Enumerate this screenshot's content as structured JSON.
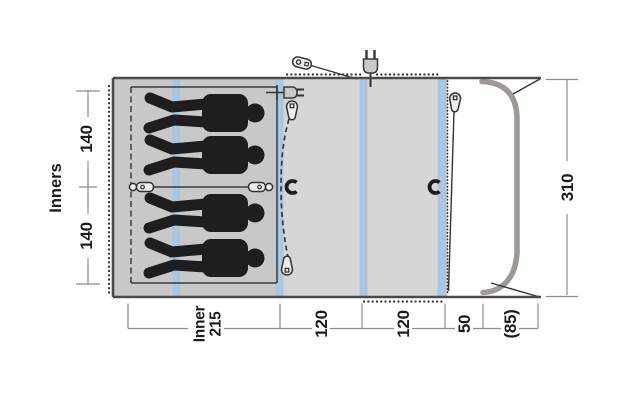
{
  "diagram": {
    "kind": "tent floor plan (top view)",
    "sleeper_count": 4
  },
  "labels": {
    "inners_title": "Inners",
    "inner_height_top": "140",
    "inner_height_bottom": "140",
    "total_depth": "310",
    "inner_width_line1": "Inner",
    "inner_width_line2": "215",
    "segment_living_1": "120",
    "segment_living_2": "120",
    "segment_front": "50",
    "segment_canopy": "(85)"
  },
  "colors": {
    "tent_fill": "#d6d6d6",
    "inner_zone_fill": "#c8c8c8",
    "pole_sleeve_blue": "#adc6e0",
    "frame_pole_gray": "#9e9896",
    "outline": "#4a4a4a",
    "silhouette": "#1e1e1e",
    "dimension_line": "#8c8c8c",
    "label_text": "#1c1c1c",
    "background": "#ffffff"
  },
  "icons": {
    "top_plug": "power-plug-icon",
    "inner_plug": "power-plug-icon",
    "door_zips": "zipper-pull-icon",
    "divider_zips": "zipper-pull-icon",
    "tiebacks": "magnet-icon"
  }
}
